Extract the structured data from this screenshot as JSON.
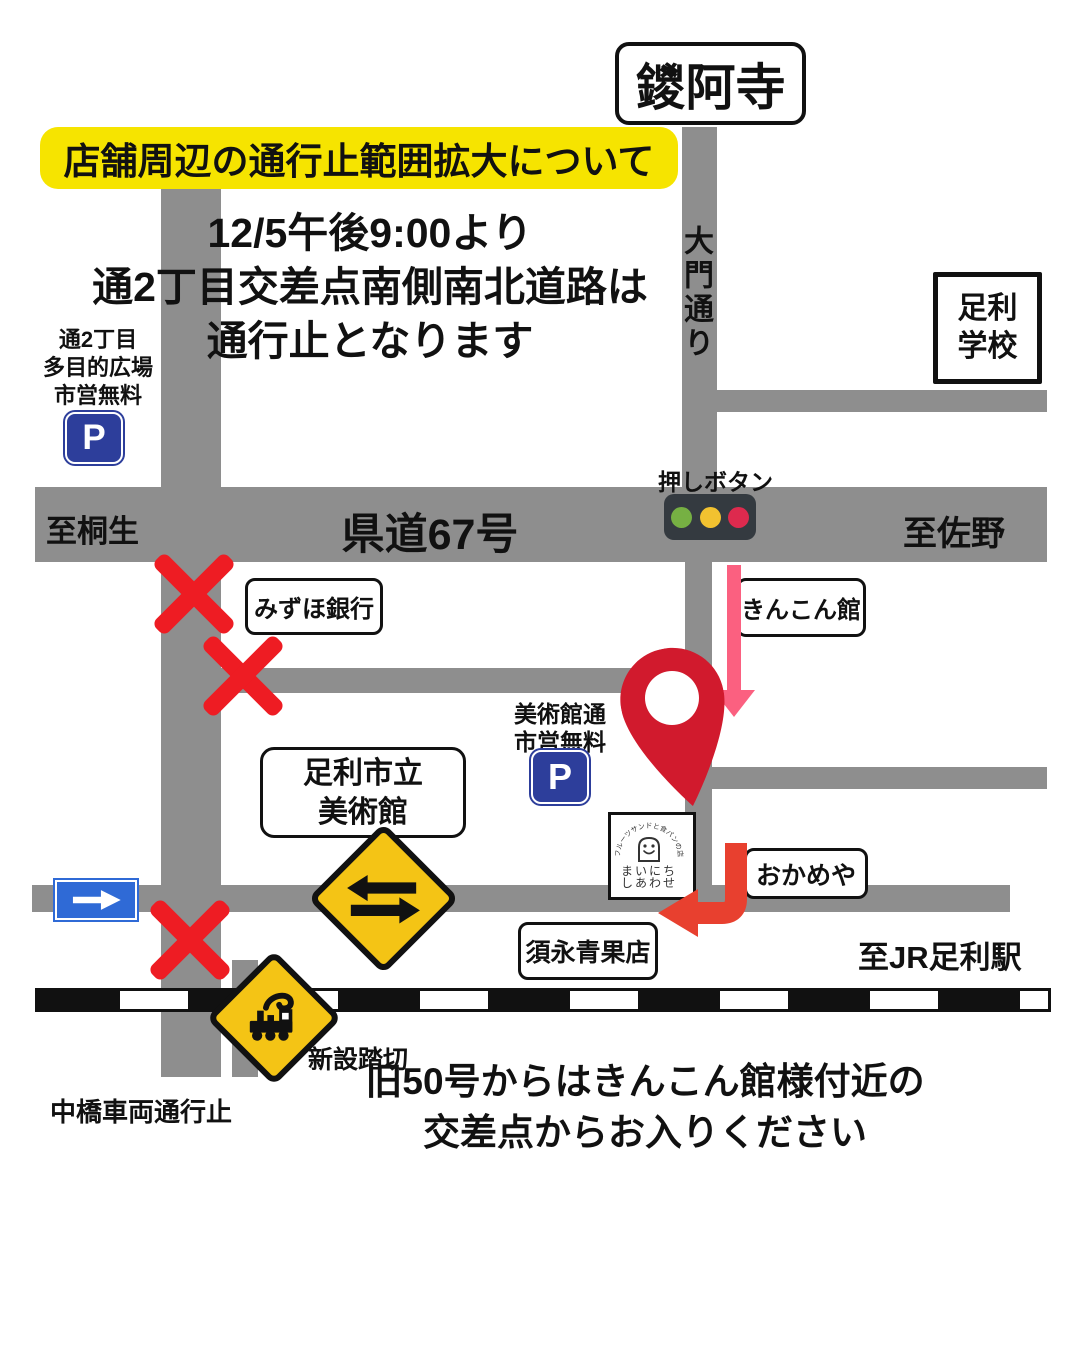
{
  "temple_sign": "鑁阿寺",
  "banner": "店舗周辺の通行止範囲拡大について",
  "notice": [
    "12/5午後9:00より",
    "通2丁目交差点南側南北道路は",
    "通行止となります"
  ],
  "parking_west": {
    "name": [
      "通2丁目",
      "多目的広場",
      "市営無料"
    ],
    "symbol": "P"
  },
  "parking_museum": {
    "name": [
      "美術館通",
      "市営無料"
    ],
    "symbol": "P"
  },
  "road_labels": {
    "route": "県道67号",
    "west": "至桐生",
    "east": "至佐野",
    "north_street": "大門通り",
    "station": "至JR足利駅"
  },
  "signal": {
    "label": "押しボタン"
  },
  "places": {
    "school": [
      "足利",
      "学校"
    ],
    "bank": "みずほ銀行",
    "kinkonkan": "きんこん館",
    "museum": [
      "足利市立",
      "美術館"
    ],
    "okameya": "おかめや",
    "grocer": "須永青果店"
  },
  "shop_logo": {
    "arc": "フルーツサンドと食パンの店",
    "line1": "まいにち",
    "line2": "しあわせ"
  },
  "crossing_label": "新設踏切",
  "bridge_note": "中橋車両通行止",
  "footer_note": [
    "旧50号からはきんこん館様付近の",
    "交差点からお入りください"
  ],
  "colors": {
    "road": "#8e8e8e",
    "banner_bg": "#f6e400",
    "sign_yellow": "#f4c415",
    "alert_red": "#ee1c23",
    "pin_red": "#d11a2d",
    "arrow_red": "#e8402f",
    "arrow_pink": "#fb6080",
    "parking_blue": "#2d3e9b",
    "oneway_blue": "#2f6ad6",
    "traffic_green": "#76b043",
    "traffic_amber": "#f2c230",
    "traffic_red": "#dd2a4e",
    "traffic_body": "#343a40",
    "rail_black": "#111111"
  }
}
